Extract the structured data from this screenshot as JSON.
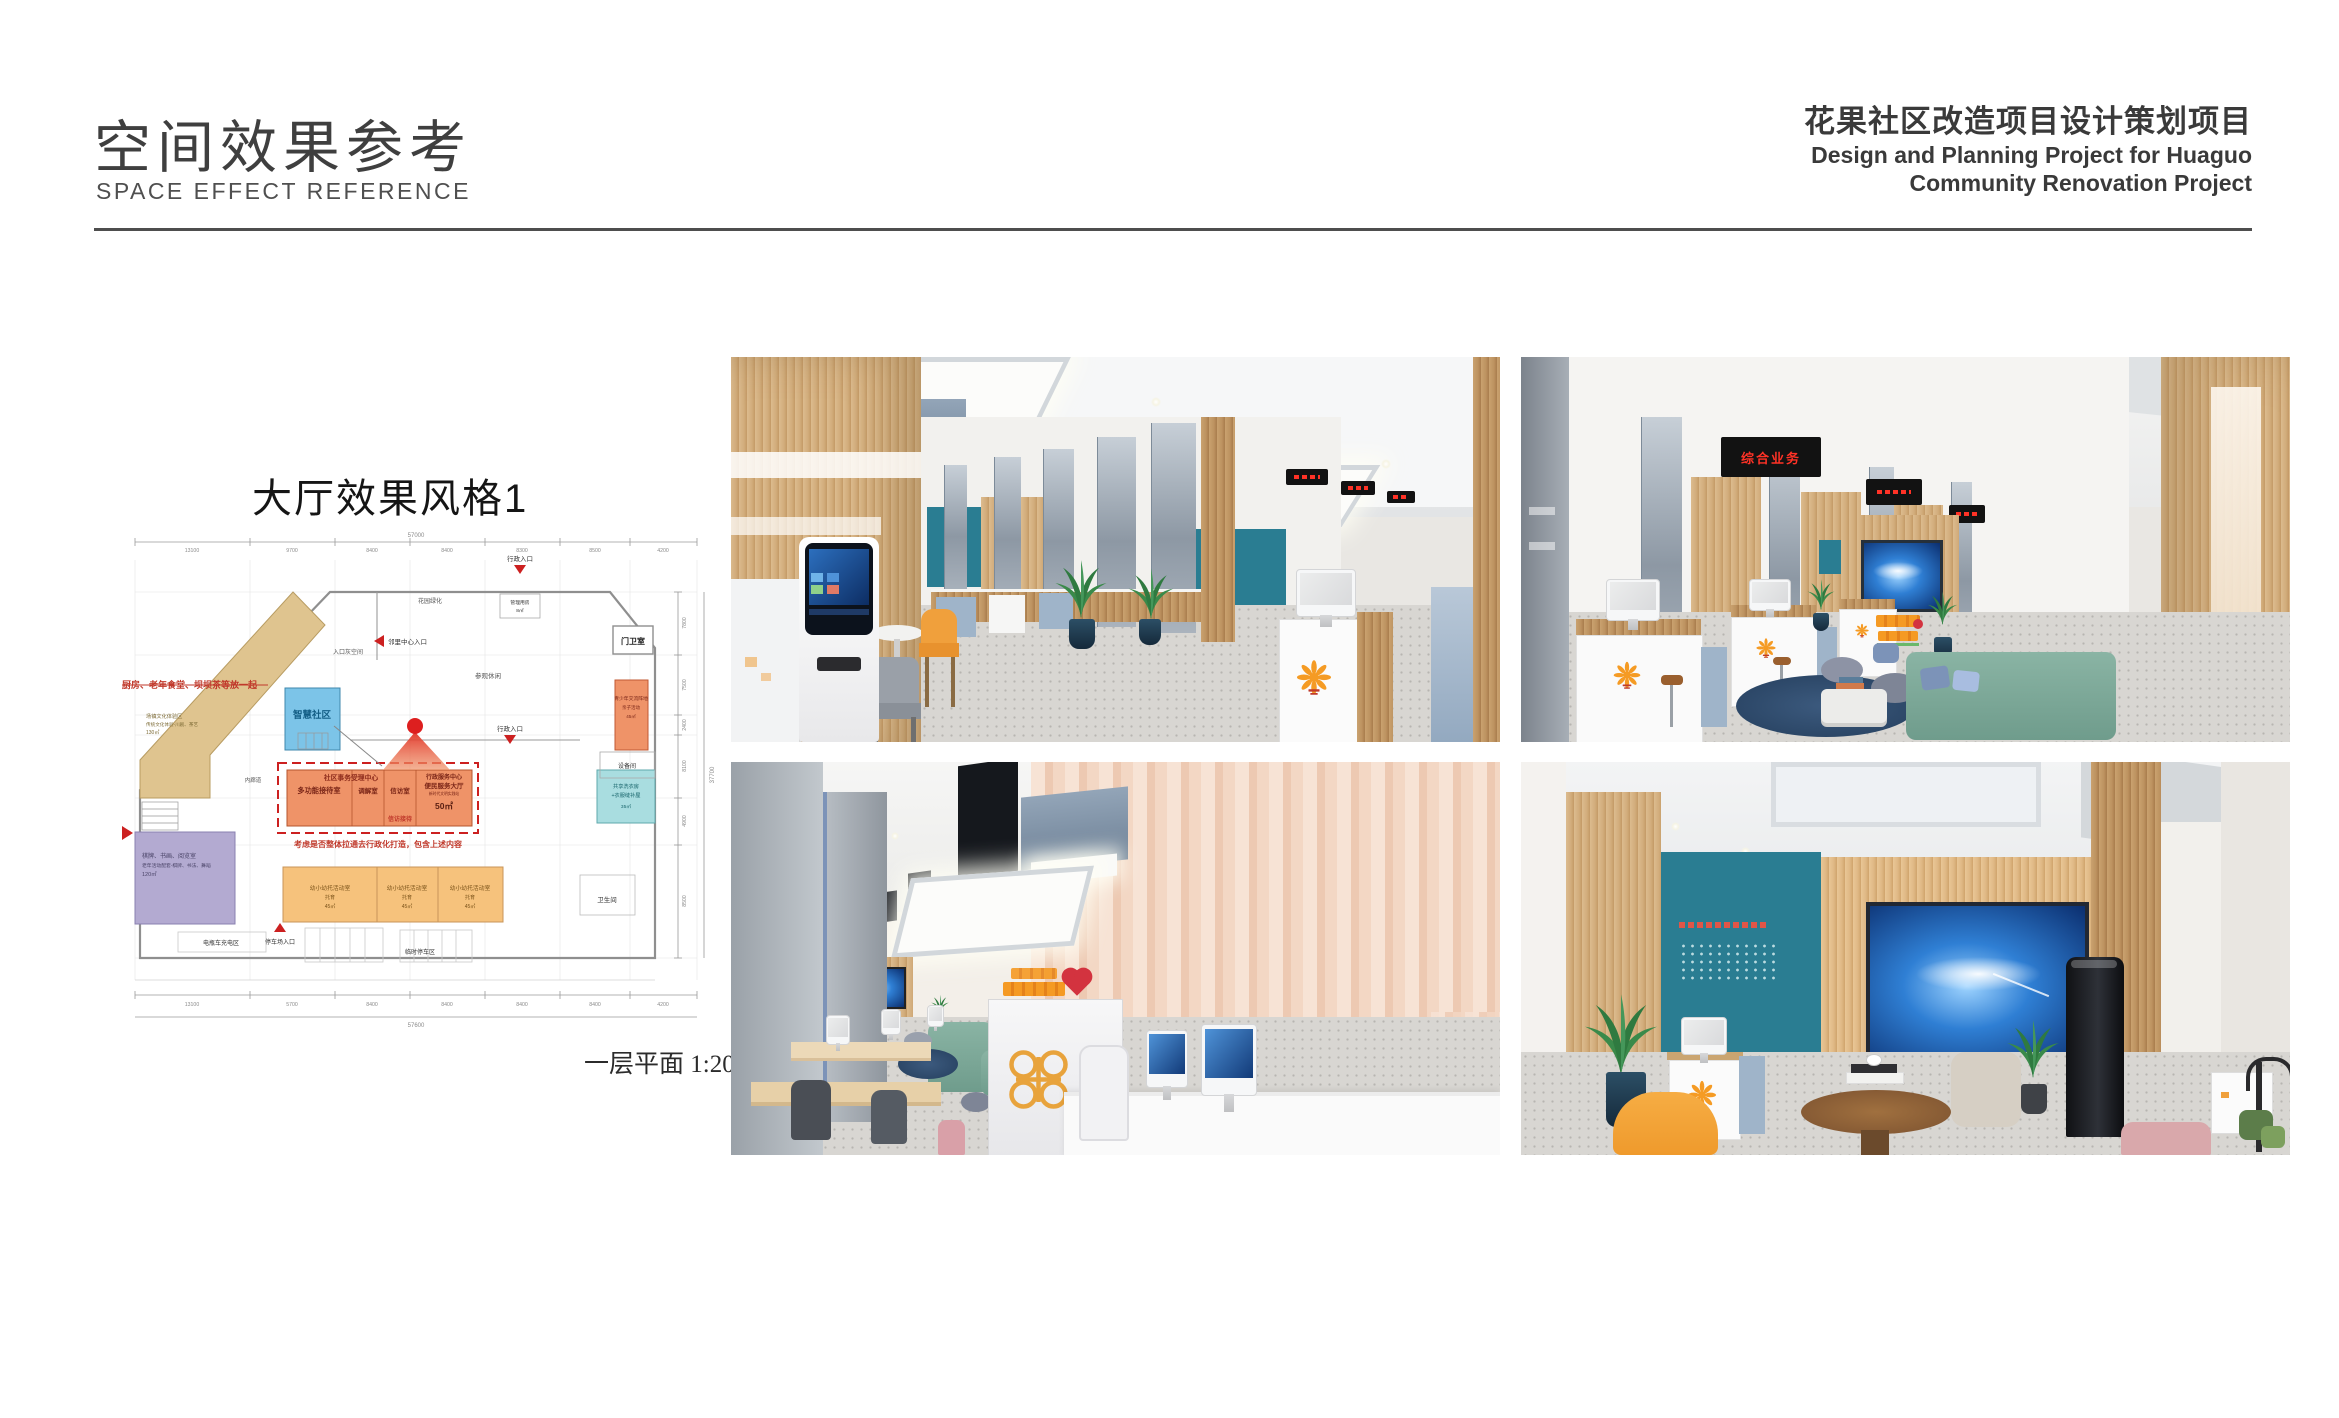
{
  "header": {
    "title_cn": "空间效果参考",
    "title_en": "SPACE EFFECT REFERENCE",
    "project_cn": "花果社区改造项目设计策划项目",
    "project_en1": "Design and Planning Project for Huaguo",
    "project_en2": "Community Renovation Project"
  },
  "plan": {
    "section_title": "大厅效果风格1",
    "caption": "一层平面 1:200",
    "notes": {
      "kitchen_note": "厨房、老年食堂、坝坝茶等放一起",
      "integration_note": "考虑是否整体拉通去行政化打造，包含上述内容"
    },
    "rooms": {
      "culture_room_line1": "场镇文化体验区",
      "culture_room_line2": "传统文化体验-川剧、茶艺",
      "culture_room_area": "130㎡",
      "smart_community": "智慧社区",
      "acceptance_center": "社区事务受理中心",
      "multifunction_room": "多功能接待室",
      "mediation_room": "调解室",
      "petition_room": "信访室",
      "petition_reception": "信访接待",
      "admin_center_line1": "行政服务中心",
      "admin_center_line2": "便民服务大厅",
      "admin_center_line3": "新时代文明实践站",
      "admin_center_area": "50㎡",
      "elderly_room_line1": "棋牌、书画、阅览室",
      "elderly_room_line2": "老年活动配套-棋牌、书法、舞蹈",
      "elderly_room_area": "120㎡",
      "childcare_room": "幼小幼托活动室",
      "childcare_room_sub": "托育",
      "childcare_room_area": "45㎡",
      "youth_room_line1": "青少年交流阵地",
      "youth_room_line2": "亲子活动",
      "youth_room_area": "45㎡",
      "equipment_room": "设备间",
      "laundry_line1": "共享洗衣房",
      "laundry_line2": "+衣服缝补屋",
      "laundry_area": "35㎡",
      "toilet": "卫生间",
      "guard_room": "门卫室",
      "management_room": "管理用房",
      "management_area": "8㎡",
      "garden": "花园绿化",
      "entrance_gray_space": "入口灰空间",
      "leisure": "参观休闲",
      "inner_corridor": "内廊道"
    },
    "entrances": {
      "neighborhood_entrance": "邻里中心入口",
      "admin_entrance": "行政入口",
      "admin_entrance_top": "行政入口",
      "parking_entrance": "停车场入口",
      "ev_charging": "电瓶车充电区",
      "temp_parking": "临时停车区"
    },
    "dimensions": {
      "top_total": "57000",
      "top_segments": [
        "13100",
        "9700",
        "8400",
        "8400",
        "8300",
        "8500",
        "4200"
      ],
      "bottom_segments": [
        "13100",
        "5700",
        "8400",
        "8400",
        "8400",
        "8400",
        "4200"
      ],
      "bottom_total": "57600",
      "right_segments": [
        "7800",
        "7500",
        "2400",
        "8100",
        "4900",
        "8500"
      ],
      "right_total": "37700"
    }
  },
  "renders": {
    "top_right": {
      "led_sign": "综合业务"
    }
  },
  "colors": {
    "accent_teal": "#2a7d92",
    "wood": "#d2b186",
    "logo_orange": "#f59a23",
    "plan_orange": "#ef9368",
    "plan_tan": "#dfc48f",
    "plan_blue": "#7cc4e8",
    "plan_purple": "#b3aad1",
    "plan_cyan": "#a9dde0",
    "plan_peach": "#f6c27c",
    "note_red": "#c0392b",
    "led_red": "#ff3226",
    "screen_blue": "#1e63c8",
    "sofa_green": "#7fae9e",
    "rug_navy": "#2e4a6b"
  }
}
